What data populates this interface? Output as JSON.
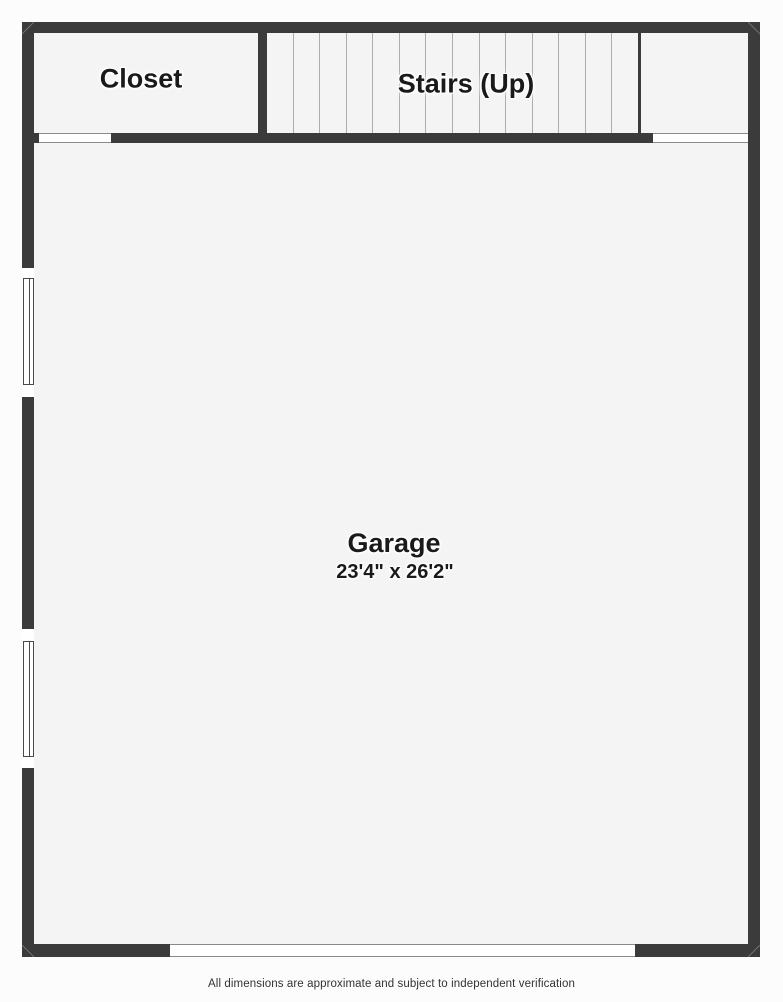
{
  "rooms": {
    "closet": {
      "label": "Closet"
    },
    "stairs": {
      "label": "Stairs (Up)",
      "tread_count": 13
    },
    "garage": {
      "label": "Garage",
      "dimensions": "23'4\" x 26'2\""
    }
  },
  "footer": {
    "disclaimer": "All dimensions are approximate and subject to independent verification"
  },
  "colors": {
    "wall": "#3b3b3c",
    "floor": "#f4f4f4",
    "background": "#fcfcfc",
    "tread_line": "#adadad",
    "opening_outline": "#8a8a8a",
    "window_outline": "#4a4a4a",
    "label_text": "#1a1a1a",
    "disclaimer_text": "#333333"
  }
}
